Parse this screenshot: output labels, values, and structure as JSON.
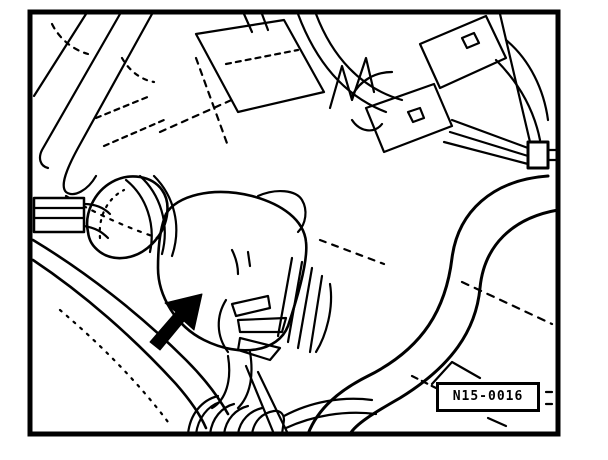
{
  "figure": {
    "number": "N15-0016"
  },
  "colors": {
    "line": "#000000",
    "background": "#ffffff"
  },
  "icons": {
    "pointer_arrow": "solid-arrow-up-right"
  }
}
